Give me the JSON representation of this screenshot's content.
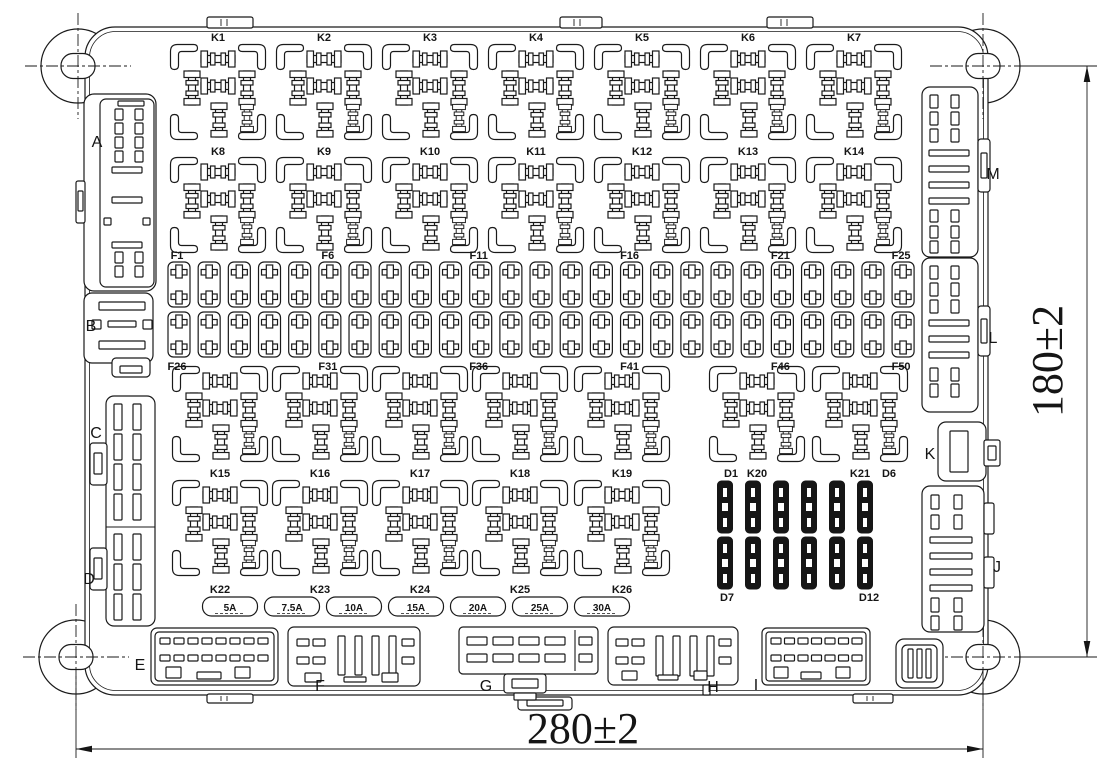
{
  "drawing": {
    "kind": "engineering-outline-drawing",
    "subject": "relay and fuse box component layout",
    "line_color": "#1a1a1a",
    "background": "#ffffff"
  },
  "dimensions": {
    "bottom": {
      "text": "280±2"
    },
    "right": {
      "text": "180±2"
    }
  },
  "relay_rows": [
    {
      "label_y": 41,
      "foot_cy": 92,
      "items": [
        {
          "label": "K1",
          "x": 218
        },
        {
          "label": "K2",
          "x": 324
        },
        {
          "label": "K3",
          "x": 430
        },
        {
          "label": "K4",
          "x": 536
        },
        {
          "label": "K5",
          "x": 642
        },
        {
          "label": "K6",
          "x": 748
        },
        {
          "label": "K7",
          "x": 854
        }
      ]
    },
    {
      "label_y": 155,
      "foot_cy": 205,
      "items": [
        {
          "label": "K8",
          "x": 218
        },
        {
          "label": "K9",
          "x": 324
        },
        {
          "label": "K10",
          "x": 430
        },
        {
          "label": "K11",
          "x": 536
        },
        {
          "label": "K12",
          "x": 642
        },
        {
          "label": "K13",
          "x": 748
        },
        {
          "label": "K14",
          "x": 854
        }
      ]
    },
    {
      "label_y": 477,
      "foot_cy": 414,
      "items": [
        {
          "label": "K15",
          "x": 220
        },
        {
          "label": "K16",
          "x": 320
        },
        {
          "label": "K17",
          "x": 420
        },
        {
          "label": "K18",
          "x": 520
        },
        {
          "label": "K19",
          "x": 622
        },
        {
          "label": "K20",
          "x": 757
        },
        {
          "label": "K21",
          "x": 860
        }
      ]
    },
    {
      "label_y": 593,
      "foot_cy": 528,
      "items": [
        {
          "label": "K22",
          "x": 220
        },
        {
          "label": "K23",
          "x": 320
        },
        {
          "label": "K24",
          "x": 420
        },
        {
          "label": "K25",
          "x": 520
        },
        {
          "label": "K26",
          "x": 622
        }
      ]
    }
  ],
  "fuse_block": {
    "x0": 179,
    "pitch": 30.17,
    "count": 25,
    "row1_cy": 284.5,
    "row2_cy": 334.5,
    "top_label_y": 259,
    "bottom_label_y": 370,
    "top_labels": [
      {
        "text": "F1",
        "fuse_index": 0
      },
      {
        "text": "F6",
        "fuse_index": 5
      },
      {
        "text": "F11",
        "fuse_index": 10
      },
      {
        "text": "F16",
        "fuse_index": 15
      },
      {
        "text": "F21",
        "fuse_index": 20
      },
      {
        "text": "F25",
        "fuse_index": 24
      }
    ],
    "bottom_labels": [
      {
        "text": "F26",
        "fuse_index": 0
      },
      {
        "text": "F31",
        "fuse_index": 5
      },
      {
        "text": "F36",
        "fuse_index": 10
      },
      {
        "text": "F41",
        "fuse_index": 15
      },
      {
        "text": "F46",
        "fuse_index": 20
      },
      {
        "text": "F50",
        "fuse_index": 24
      }
    ]
  },
  "diode_block": {
    "cols_x": [
      725,
      753,
      781,
      809,
      837,
      865
    ],
    "row1_cy": 507,
    "row2_cy": 563,
    "corner_labels": [
      {
        "text": "D1",
        "x": 731,
        "y": 477
      },
      {
        "text": "D6",
        "x": 889,
        "y": 477
      },
      {
        "text": "D7",
        "x": 727,
        "y": 601
      },
      {
        "text": "D12",
        "x": 869,
        "y": 601
      }
    ]
  },
  "fuse_ratings": {
    "y": 597,
    "center0": 230,
    "pitch": 62,
    "w": 55,
    "h": 19,
    "values": [
      "5A",
      "7.5A",
      "10A",
      "15A",
      "20A",
      "25A",
      "30A"
    ]
  },
  "connector_labels": [
    {
      "text": "A",
      "x": 97,
      "y": 147
    },
    {
      "text": "B",
      "x": 91,
      "y": 331
    },
    {
      "text": "C",
      "x": 96,
      "y": 438
    },
    {
      "text": "D",
      "x": 89,
      "y": 584
    },
    {
      "text": "E",
      "x": 140,
      "y": 670
    },
    {
      "text": "F",
      "x": 320,
      "y": 691
    },
    {
      "text": "G",
      "x": 486,
      "y": 691
    },
    {
      "text": "H",
      "x": 713,
      "y": 692
    },
    {
      "text": "I",
      "x": 756,
      "y": 690
    },
    {
      "text": "J",
      "x": 997,
      "y": 572
    },
    {
      "text": "K",
      "x": 930,
      "y": 459
    },
    {
      "text": "L",
      "x": 993,
      "y": 343
    },
    {
      "text": "M",
      "x": 993,
      "y": 179
    }
  ]
}
